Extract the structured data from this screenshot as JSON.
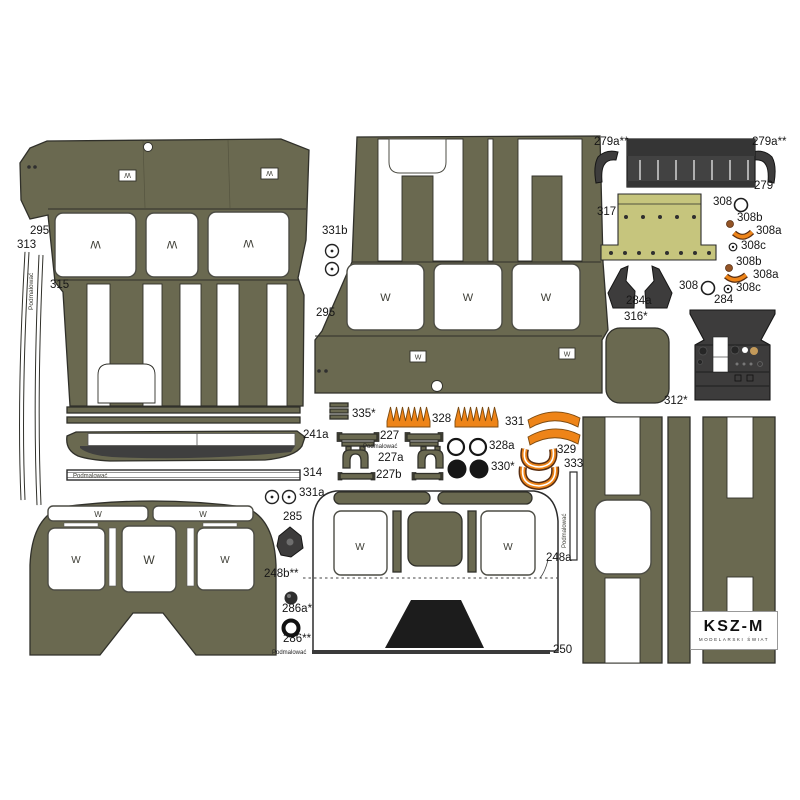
{
  "brand": {
    "name": "KSZ-M",
    "subtitle": "MODELARSKI ŚWIAT"
  },
  "glyphs": {
    "w": "W",
    "paint_note": "Podmalować"
  },
  "parts": {
    "p295": "295",
    "p313": "313",
    "p315": "315",
    "p331b": "331b",
    "p279a": "279a**",
    "p279": "279",
    "p317": "317",
    "p308": "308",
    "p308a": "308a",
    "p308b": "308b",
    "p308c": "308c",
    "p284a": "284a",
    "p284": "284",
    "p316": "316*",
    "p312": "312*",
    "p335": "335*",
    "p328": "328",
    "p328a": "328a",
    "p331": "331",
    "p331a": "331a",
    "p330": "330*",
    "p329": "329",
    "p333": "333",
    "p227": "227",
    "p227a": "227a",
    "p227b": "227b",
    "p241a": "241a",
    "p314": "314",
    "p285": "285",
    "p248a": "248a",
    "p248b": "248b**",
    "p286a": "286a*",
    "p286": "286**",
    "p250": "250"
  },
  "colors": {
    "olive": "#6a6950",
    "outline": "#30302a",
    "dark": "#3d3c3c",
    "grille": "#424242",
    "black": "#1c1c1c",
    "yellow": "#c6c57d",
    "orange": "#ee8418",
    "orangeline": "#7c4a10",
    "brown": "#935426",
    "winstroke": "#4c4c44"
  }
}
